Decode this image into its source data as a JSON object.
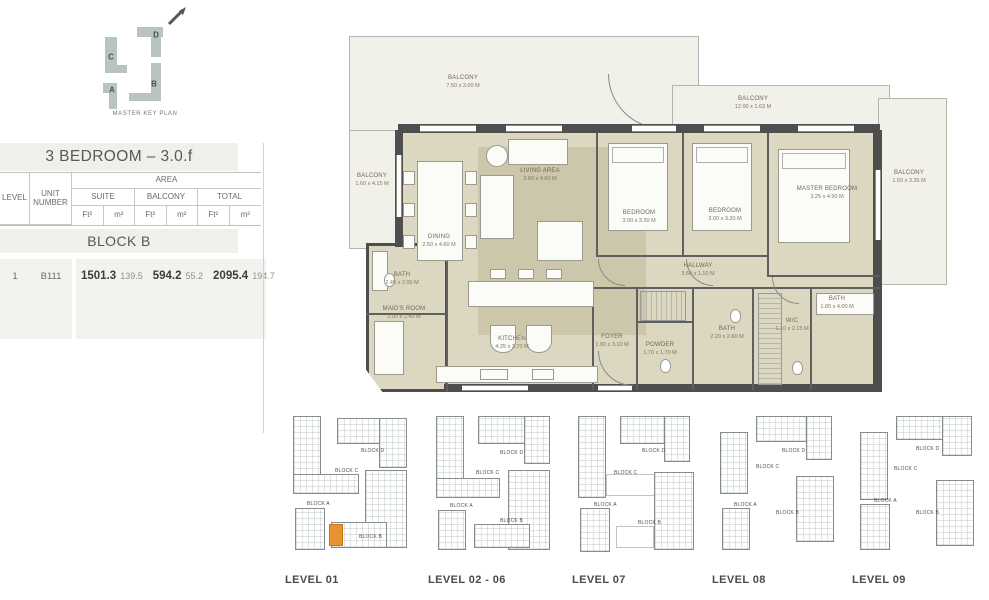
{
  "colors": {
    "accent_orange": "#e8932f",
    "plan_beige": "#dcd7c1",
    "balcony_fill": "#f1f1e9",
    "wall": "#4e4e4e",
    "keyplan_fill": "#b9c3bf",
    "band_gray": "#f0efec"
  },
  "master_key_plan": {
    "caption": "MASTER KEY PLAN",
    "letters": [
      "A",
      "B",
      "C",
      "D"
    ]
  },
  "info_table": {
    "title": "3 BEDROOM – 3.0.f",
    "headers": {
      "level": "LEVEL",
      "unit_number": "UNIT NUMBER",
      "area": "AREA",
      "suite": "SUITE",
      "balcony": "BALCONY",
      "total": "TOTAL",
      "ft": "Ft²",
      "m": "m²"
    },
    "block_title": "BLOCK B",
    "row": {
      "level": "1",
      "unit": "B111",
      "suite_ft": "1501.3",
      "suite_m": "139.5",
      "balcony_ft": "594.2",
      "balcony_m": "55.2",
      "total_ft": "2095.4",
      "total_m": "194.7"
    }
  },
  "floor_plan": {
    "rooms": [
      {
        "name": "BALCONY",
        "dims": "7.50 x 3.00 M",
        "x": 123,
        "y": 57
      },
      {
        "name": "BALCONY",
        "dims": "12.00 x 1.63 M",
        "x": 413,
        "y": 78
      },
      {
        "name": "BALCONY",
        "dims": "1.60 x 4.15 M",
        "x": 32,
        "y": 155
      },
      {
        "name": "BALCONY",
        "dims": "1.50 x 3.35 M",
        "x": 569,
        "y": 152
      },
      {
        "name": "LIVING AREA",
        "dims": "3.60 x 4.60 M",
        "x": 200,
        "y": 150
      },
      {
        "name": "DINING",
        "dims": "2.50 x 4.60 M",
        "x": 99,
        "y": 216
      },
      {
        "name": "BEDROOM",
        "dims": "3.00 x 3.30 M",
        "x": 299,
        "y": 192
      },
      {
        "name": "BEDROOM",
        "dims": "3.00 x 3.30 M",
        "x": 385,
        "y": 190
      },
      {
        "name": "MASTER BEDROOM",
        "dims": "3.25 x 4.90 M",
        "x": 487,
        "y": 168
      },
      {
        "name": "BATH",
        "dims": "2.45 x 2.00 M",
        "x": 62,
        "y": 254
      },
      {
        "name": "MAID'S ROOM",
        "dims": "2.00 x 2.40 M",
        "x": 64,
        "y": 288
      },
      {
        "name": "KITCHEN",
        "dims": "4.25 x 3.70 M",
        "x": 172,
        "y": 318
      },
      {
        "name": "FOYER",
        "dims": "1.00 x 3.10 M",
        "x": 272,
        "y": 316
      },
      {
        "name": "POWDER",
        "dims": "1.70 x 1.70 M",
        "x": 320,
        "y": 324
      },
      {
        "name": "HALLWAY",
        "dims": "3.50 x 1.10 M",
        "x": 358,
        "y": 245
      },
      {
        "name": "BATH",
        "dims": "2.20 x 2.60 M",
        "x": 387,
        "y": 308
      },
      {
        "name": "W/C",
        "dims": "1.10 x 2.15 M",
        "x": 452,
        "y": 300
      },
      {
        "name": "BATH",
        "dims": "1.80 x 4.00 M",
        "x": 497,
        "y": 278
      }
    ]
  },
  "levels": [
    {
      "id": "01",
      "caption": "LEVEL 01",
      "x": 285,
      "highlight": [
        44,
        116,
        14,
        22
      ],
      "blocks": [
        {
          "label": "BLOCK D",
          "lx": 76,
          "ly": 40,
          "rects": [
            [
              52,
              10,
              70,
              26
            ],
            [
              94,
              10,
              28,
              50
            ]
          ]
        },
        {
          "label": "BLOCK C",
          "lx": 50,
          "ly": 60,
          "rects": [
            [
              8,
              8,
              28,
              78
            ],
            [
              8,
              66,
              66,
              20
            ]
          ]
        },
        {
          "label": "BLOCK A",
          "lx": 22,
          "ly": 93,
          "rects": [
            [
              10,
              100,
              30,
              42
            ]
          ]
        },
        {
          "label": "BLOCK B",
          "lx": 74,
          "ly": 126,
          "rects": [
            [
              80,
              62,
              42,
              78
            ],
            [
              46,
              114,
              56,
              26
            ]
          ]
        }
      ],
      "roofs": []
    },
    {
      "id": "02-06",
      "caption": "LEVEL 02 - 06",
      "x": 428,
      "highlight": null,
      "blocks": [
        {
          "label": "BLOCK D",
          "lx": 72,
          "ly": 42,
          "rects": [
            [
              50,
              8,
              72,
              28
            ],
            [
              96,
              8,
              26,
              48
            ]
          ]
        },
        {
          "label": "BLOCK C",
          "lx": 48,
          "ly": 62,
          "rects": [
            [
              8,
              8,
              28,
              82
            ],
            [
              8,
              70,
              64,
              20
            ]
          ]
        },
        {
          "label": "BLOCK A",
          "lx": 22,
          "ly": 95,
          "rects": [
            [
              10,
              102,
              28,
              40
            ]
          ]
        },
        {
          "label": "BLOCK B",
          "lx": 72,
          "ly": 110,
          "rects": [
            [
              80,
              62,
              42,
              80
            ],
            [
              46,
              116,
              56,
              24
            ]
          ]
        }
      ],
      "roofs": []
    },
    {
      "id": "07",
      "caption": "LEVEL 07",
      "x": 572,
      "highlight": null,
      "blocks": [
        {
          "label": "BLOCK D",
          "lx": 70,
          "ly": 40,
          "rects": [
            [
              48,
              8,
              70,
              28
            ],
            [
              92,
              8,
              26,
              46
            ]
          ]
        },
        {
          "label": "BLOCK C",
          "lx": 42,
          "ly": 62,
          "rects": [
            [
              6,
              8,
              28,
              82
            ]
          ]
        },
        {
          "label": "BLOCK A",
          "lx": 22,
          "ly": 94,
          "rects": [
            [
              8,
              100,
              30,
              44
            ]
          ]
        },
        {
          "label": "BLOCK B",
          "lx": 66,
          "ly": 112,
          "rects": [
            [
              82,
              64,
              40,
              78
            ]
          ]
        }
      ],
      "roofs": [
        [
          34,
          66,
          54,
          22
        ],
        [
          44,
          118,
          38,
          22
        ]
      ]
    },
    {
      "id": "08",
      "caption": "LEVEL 08",
      "x": 712,
      "highlight": null,
      "blocks": [
        {
          "label": "BLOCK D",
          "lx": 70,
          "ly": 40,
          "rects": [
            [
              44,
              8,
              76,
              26
            ],
            [
              94,
              8,
              26,
              44
            ]
          ]
        },
        {
          "label": "BLOCK C",
          "lx": 44,
          "ly": 56,
          "rects": [
            [
              8,
              24,
              28,
              62
            ]
          ]
        },
        {
          "label": "BLOCK A",
          "lx": 22,
          "ly": 94,
          "rects": [
            [
              10,
              100,
              28,
              42
            ]
          ]
        },
        {
          "label": "BLOCK B",
          "lx": 64,
          "ly": 102,
          "rects": [
            [
              84,
              68,
              38,
              66
            ]
          ]
        }
      ],
      "roofs": []
    },
    {
      "id": "09",
      "caption": "LEVEL 09",
      "x": 852,
      "highlight": null,
      "blocks": [
        {
          "label": "BLOCK D",
          "lx": 64,
          "ly": 38,
          "rects": [
            [
              44,
              8,
              72,
              24
            ],
            [
              90,
              8,
              30,
              40
            ]
          ]
        },
        {
          "label": "BLOCK C",
          "lx": 42,
          "ly": 58,
          "rects": [
            [
              8,
              24,
              28,
              68
            ]
          ]
        },
        {
          "label": "BLOCK A",
          "lx": 22,
          "ly": 90,
          "rects": [
            [
              8,
              96,
              30,
              46
            ]
          ]
        },
        {
          "label": "BLOCK B",
          "lx": 64,
          "ly": 102,
          "rects": [
            [
              84,
              72,
              38,
              66
            ]
          ]
        }
      ],
      "roofs": []
    }
  ]
}
